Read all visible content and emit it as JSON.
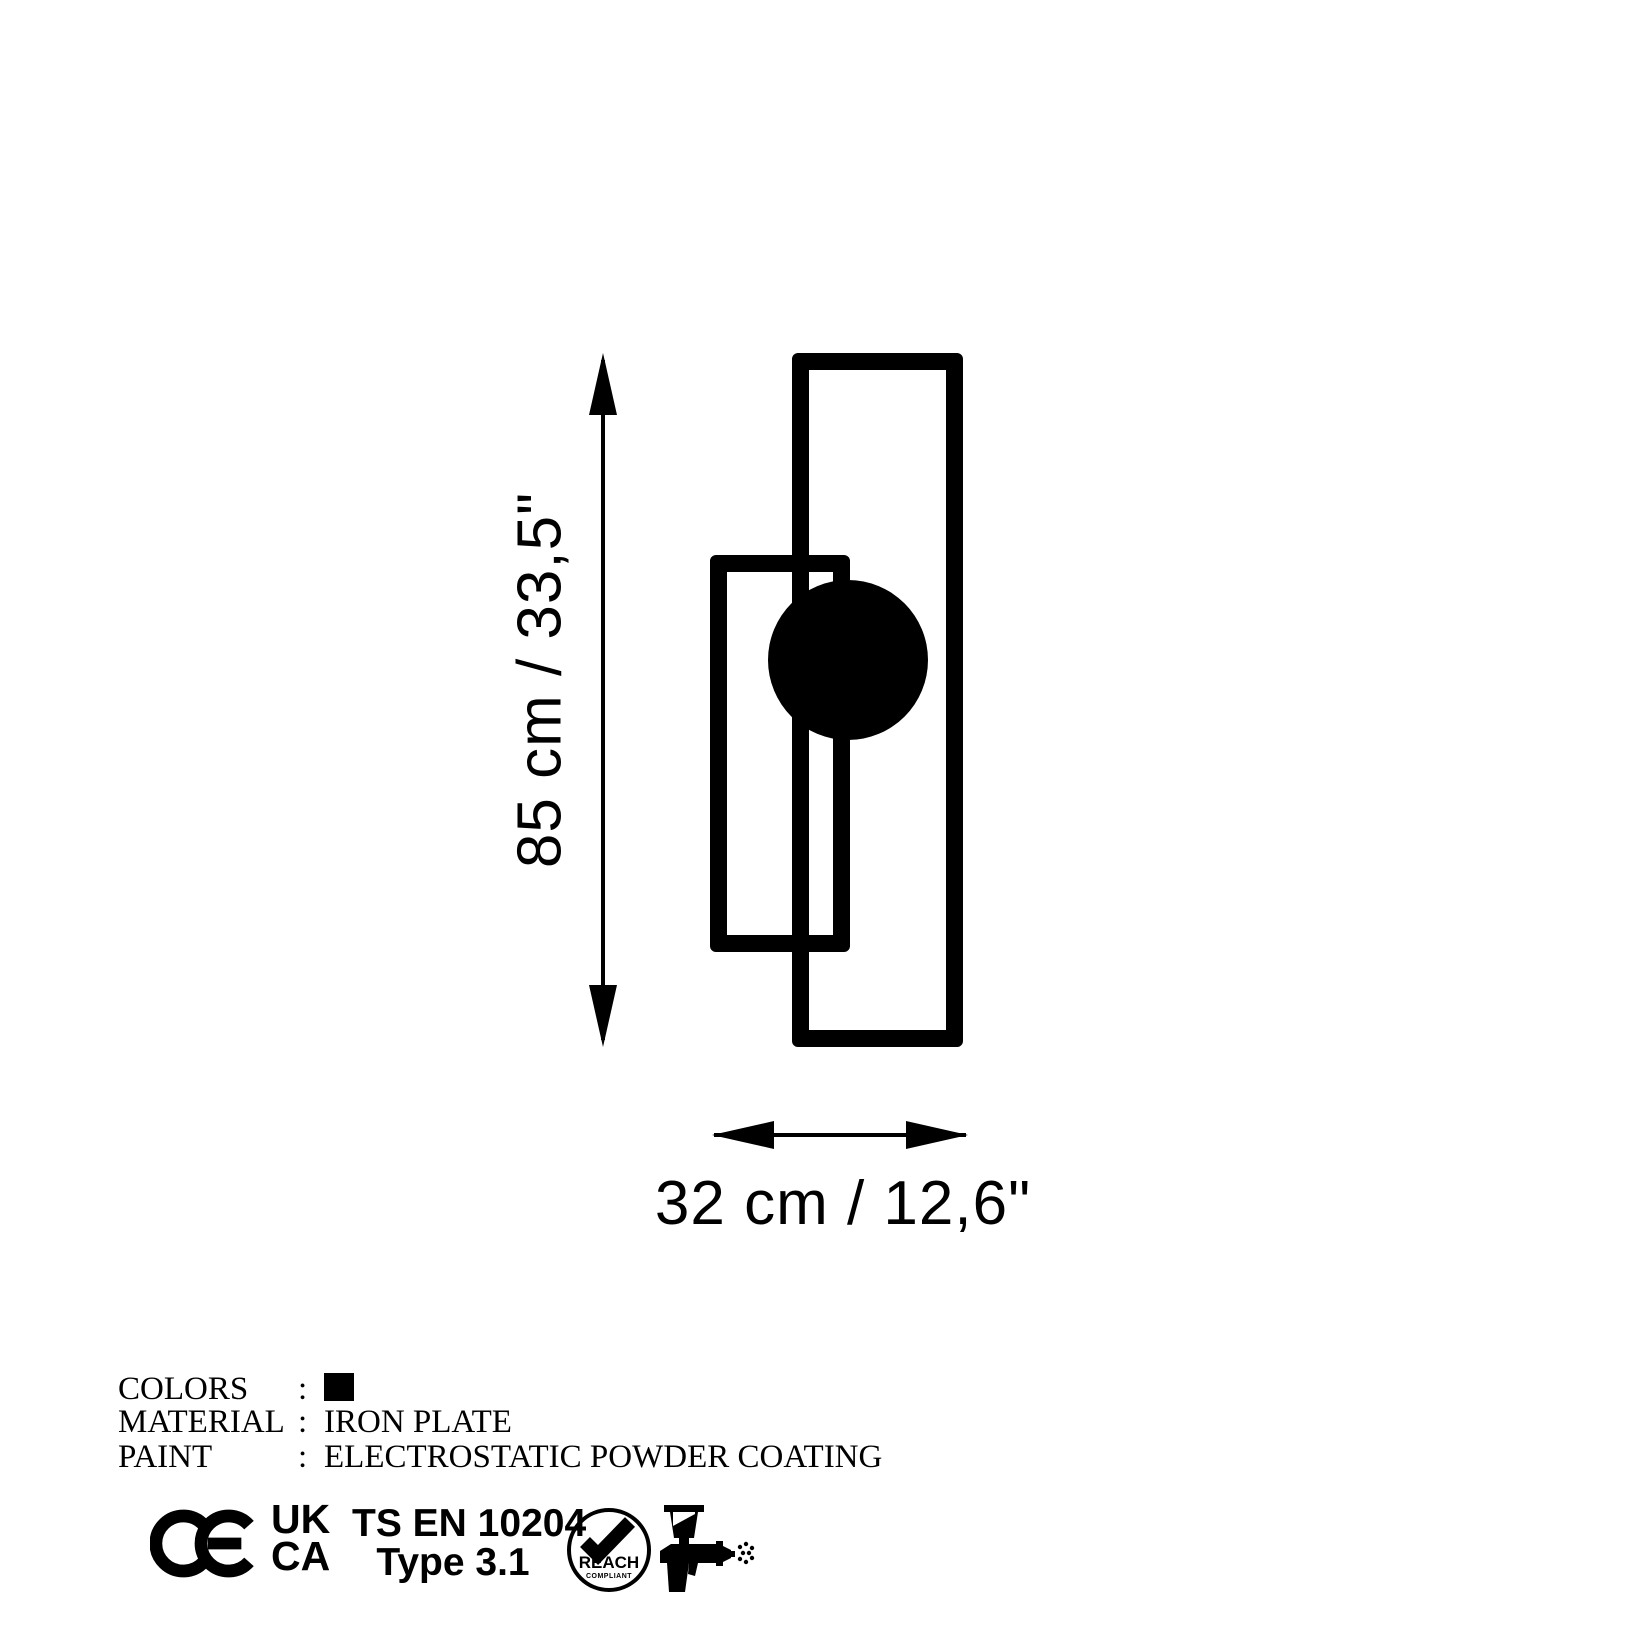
{
  "page": {
    "background": "#ffffff",
    "ink": "#000000"
  },
  "dimensions": {
    "height_label": "85 cm / 33,5\"",
    "width_label": "32 cm / 12,6\""
  },
  "specs": [
    {
      "label": "COLORS",
      "colon": ":",
      "value": "",
      "swatch": "#000000"
    },
    {
      "label": "MATERIAL",
      "colon": ":",
      "value": "IRON PLATE"
    },
    {
      "label": "PAINT",
      "colon": ":",
      "value": "ELECTROSTATIC POWDER COATING"
    }
  ],
  "certifications": {
    "ukca_top": "UK",
    "ukca_bottom": "CA",
    "standard": "TS EN 10204",
    "standard_type": "Type 3.1",
    "reach": "REACH",
    "reach_sub": "COMPLIANT"
  }
}
